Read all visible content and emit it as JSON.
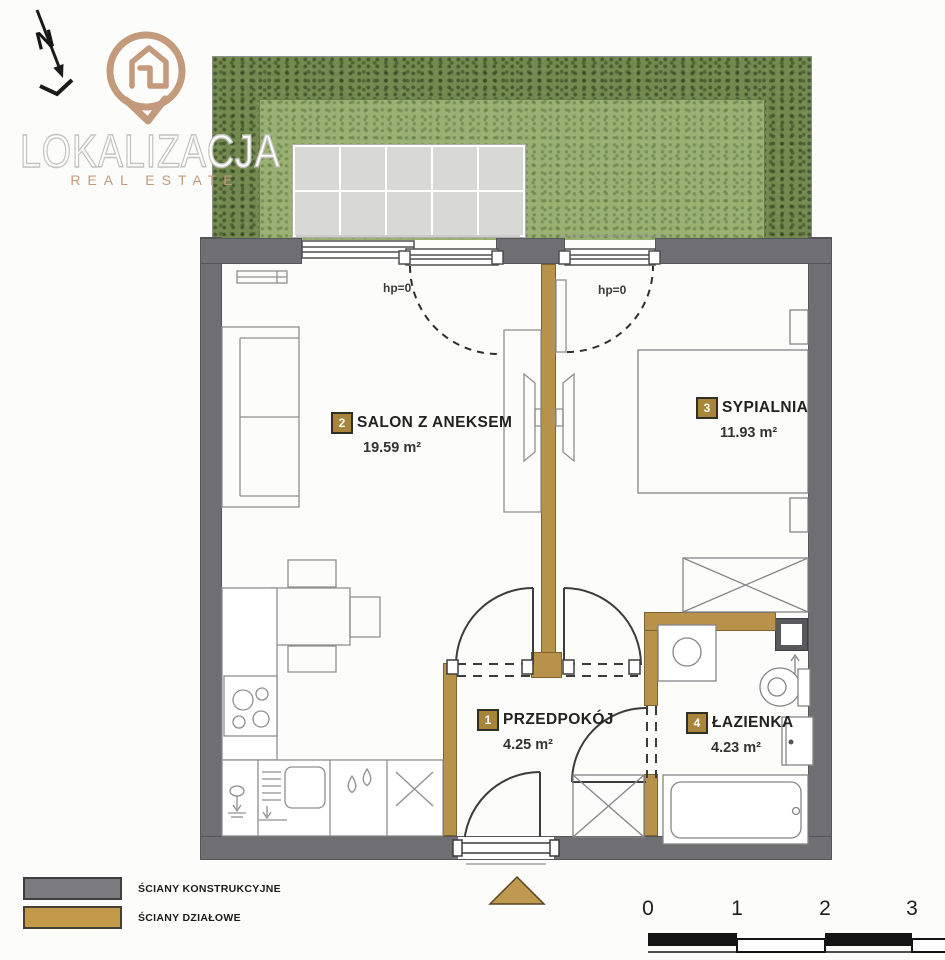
{
  "brand": {
    "name": "LOKALIZACJA",
    "tagline": "REAL ESTATE"
  },
  "compass": {
    "label": "N"
  },
  "rooms": [
    {
      "id": "2",
      "name": "SALON Z ANEKSEM",
      "area": "19.59 m²"
    },
    {
      "id": "3",
      "name": "SYPIALNIA",
      "area": "11.93 m²"
    },
    {
      "id": "1",
      "name": "PRZEDPOKÓJ",
      "area": "4.25 m²"
    },
    {
      "id": "4",
      "name": "ŁAZIENKA",
      "area": "4.23 m²"
    }
  ],
  "annotations": {
    "salon_window_sill": "hp=0",
    "bedroom_window_sill": "hp=0"
  },
  "legend": {
    "items": [
      {
        "label": "ŚCIANY KONSTRUKCYJNE",
        "color": "#7b7b7d"
      },
      {
        "label": "ŚCIANY DZIAŁOWE",
        "color": "#c39a4a"
      }
    ]
  },
  "scale_bar": {
    "ticks": [
      "0",
      "1",
      "2",
      "3"
    ]
  },
  "colors": {
    "structural_wall": "#6f6f71",
    "partition_wall": "#b8924b",
    "hedge": "#74894f",
    "lawn": "#9ab173",
    "patio_tile": "#d8d8d6",
    "brand_accent": "#c49a7c",
    "entrance_marker": "#bf9950"
  }
}
